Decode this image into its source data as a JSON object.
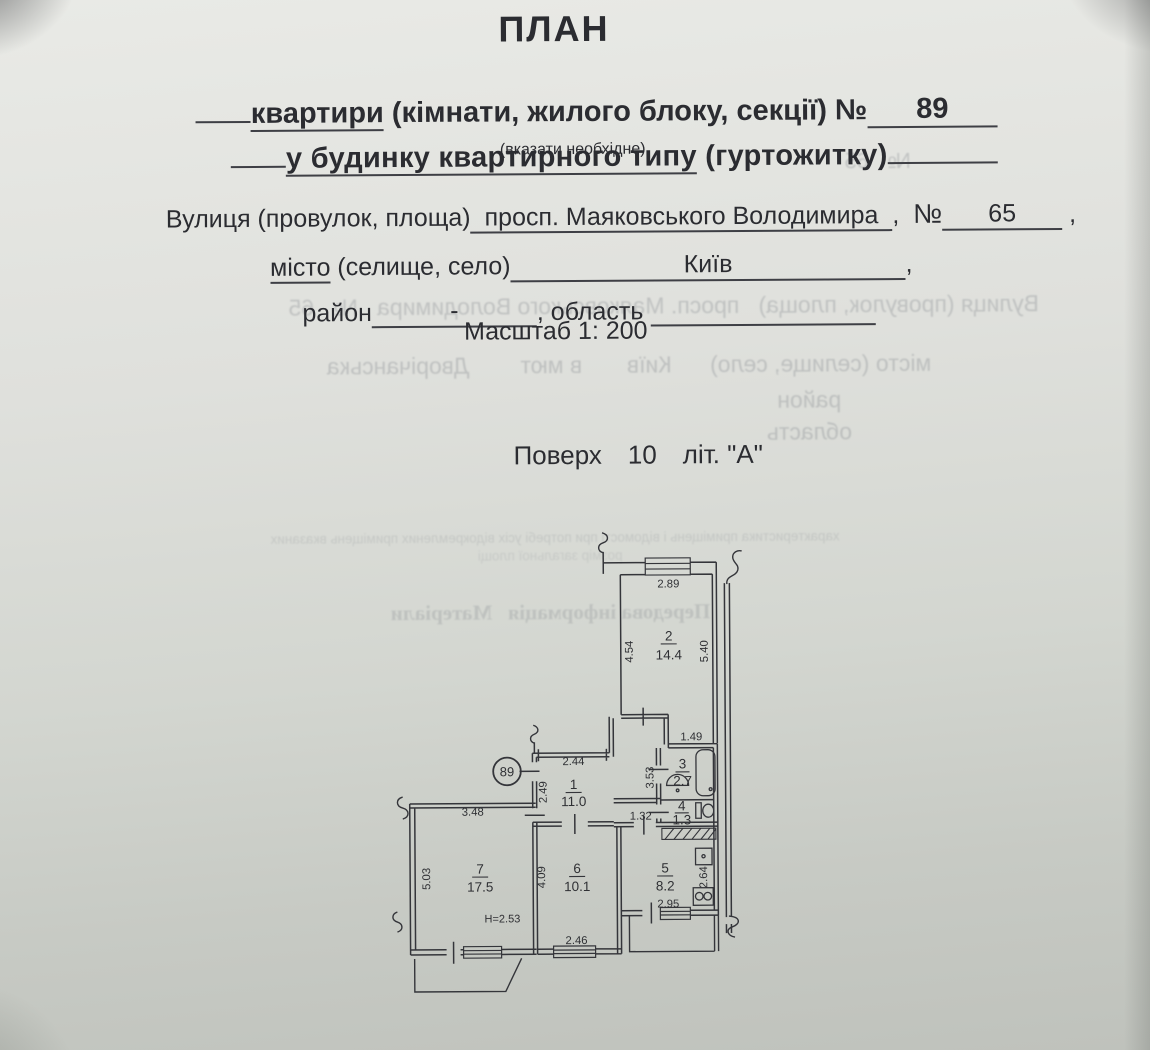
{
  "colors": {
    "paper_top": "#e9eae6",
    "paper_bottom": "#bfc2bc",
    "ink": "#2b2c31",
    "plan_ink": "#34353a"
  },
  "header": {
    "title": "ПЛАН",
    "subject_word": "квартири",
    "subject_rest": " (кімнати, жилого блоку, секції) ",
    "number_sign": "№",
    "subject_number": "89",
    "building_main": "у будинку квартирного типу",
    "building_paren": " (гуртожитку)",
    "note": "(вказати необхідне)",
    "street_label": "Вулиця (провулок, площа)",
    "street_value": "просп. Маяковського Володимира",
    "street_comma": ",  ",
    "street_number_sign": "№",
    "street_number": "65",
    "street_tail": " ,",
    "city_label_underlined": "місто",
    "city_label_rest": " (селище, село)",
    "city_value": "Київ",
    "city_tail": ",",
    "district_label": "район",
    "district_value": "-",
    "district_mid": ", область ",
    "scale_line": "Масштаб 1: 200",
    "floor_label": "Поверх",
    "floor_value": "10",
    "floor_letter": "літ. \"А\""
  },
  "plan": {
    "entry_badge": "89",
    "height_note": "Н=2.53",
    "rooms": {
      "r1": {
        "num": "1",
        "area": "11.0"
      },
      "r2": {
        "num": "2",
        "area": "14.4"
      },
      "r3": {
        "num": "3",
        "area": "2.7"
      },
      "r4": {
        "num": "4",
        "area": "1.3"
      },
      "r5": {
        "num": "5",
        "area": "8.2"
      },
      "r6": {
        "num": "6",
        "area": "10.1"
      },
      "r7": {
        "num": "7",
        "area": "17.5"
      }
    },
    "dims": {
      "r2_top": "2.89",
      "r2_left": "4.54",
      "r2_right": "5.40",
      "bath_top": "1.49",
      "bath_left": "3.53",
      "hall_top": "2.44",
      "hall_left": "2.49",
      "corridor": "1.32",
      "r7_top": "3.48",
      "r7_left": "5.03",
      "r6_left": "4.09",
      "r6_bottom": "2.46",
      "r5_bottom": "2.95",
      "r5_right": "2.64"
    }
  },
  "bleedthrough": {
    "line1": "Вулиця (провулок, площа)   просп. Маяковського Володимира   №   65",
    "line2": "місто (селище, село)      Київ       в мют        Дворічанська",
    "line3": "район",
    "line4": "область",
    "line5": "Передова інформація   Матеріали",
    "line6": "характеристика приміщень і відомості при потребі усіх відокремлених приміщень вказаних",
    "line7": "розмір загальної площі",
    "line8": "№   65"
  }
}
